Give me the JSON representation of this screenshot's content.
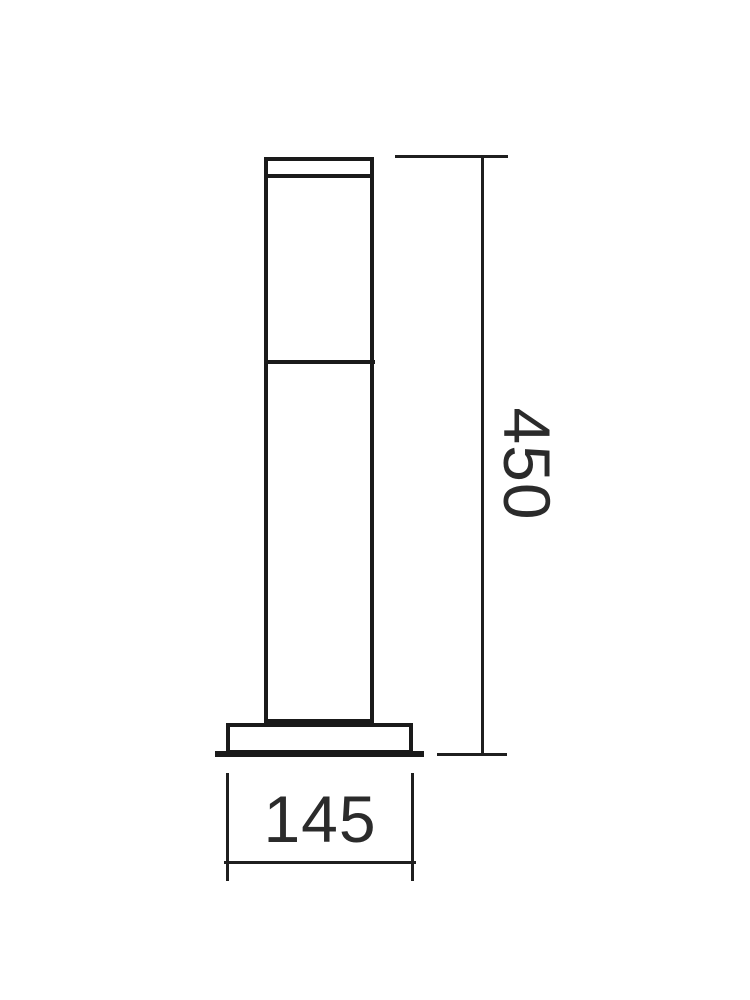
{
  "diagram": {
    "type": "technical-dimension-drawing",
    "subject": "bollard-post-light-front-elevation",
    "height_dimension": {
      "label": "450"
    },
    "width_dimension": {
      "label": "145"
    },
    "colors": {
      "line": "#1a1a1a",
      "dimension_line": "#1f1f1f",
      "text": "#2b2b2b",
      "background": "#ffffff"
    }
  }
}
